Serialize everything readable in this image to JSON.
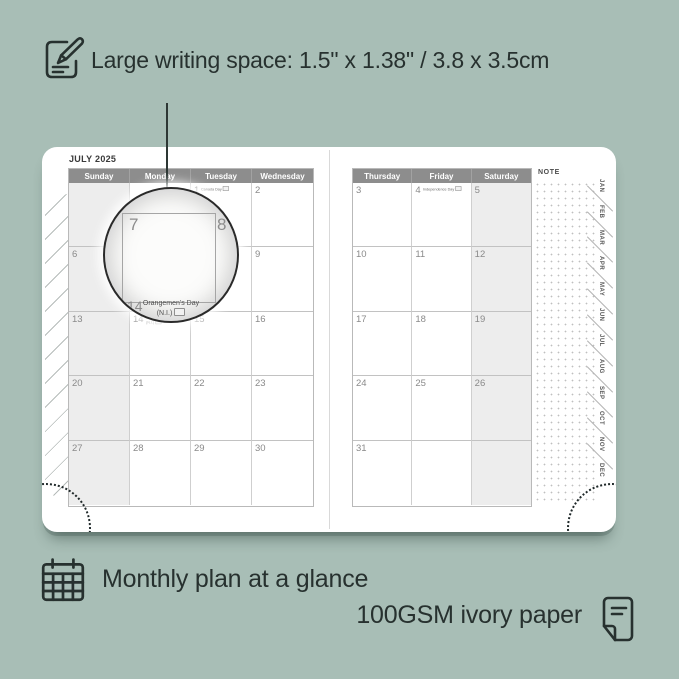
{
  "colors": {
    "background": "#a8beb6",
    "ink": "#27312f",
    "header_bar": "#8d8d8d",
    "shaded_column": "#ededed",
    "page": "#ffffff"
  },
  "callouts": {
    "writing_space": {
      "text": "Large writing space: 1.5\" x 1.38\" / 3.8 x 3.5cm",
      "icon": "pencil-note-icon"
    },
    "monthly_plan": {
      "text": "Monthly plan at a glance",
      "icon": "calendar-grid-icon"
    },
    "paper": {
      "text": "100GSM ivory paper",
      "icon": "paper-sheet-icon"
    }
  },
  "planner": {
    "month_title": "JULY 2025",
    "note_label": "NOTE",
    "left_page": {
      "headers": [
        "Sunday",
        "Monday",
        "Tuesday",
        "Wednesday"
      ],
      "rows": [
        [
          {
            "day": ""
          },
          {
            "day": ""
          },
          {
            "day": "1",
            "holiday": "Canada Day"
          },
          {
            "day": "2"
          }
        ],
        [
          {
            "day": "6"
          },
          {
            "day": "7"
          },
          {
            "day": "8"
          },
          {
            "day": "9"
          }
        ],
        [
          {
            "day": "13"
          },
          {
            "day": "14",
            "holiday": "Orangemen's Day",
            "holiday2": "(N.I.)"
          },
          {
            "day": "15"
          },
          {
            "day": "16"
          }
        ],
        [
          {
            "day": "20"
          },
          {
            "day": "21"
          },
          {
            "day": "22"
          },
          {
            "day": "23"
          }
        ],
        [
          {
            "day": "27"
          },
          {
            "day": "28"
          },
          {
            "day": "29"
          },
          {
            "day": "30"
          }
        ]
      ]
    },
    "right_page": {
      "headers": [
        "Thursday",
        "Friday",
        "Saturday"
      ],
      "rows": [
        [
          {
            "day": "3"
          },
          {
            "day": "4",
            "holiday": "Independence Day"
          },
          {
            "day": "5"
          }
        ],
        [
          {
            "day": "10"
          },
          {
            "day": "11"
          },
          {
            "day": "12"
          }
        ],
        [
          {
            "day": "17"
          },
          {
            "day": "18"
          },
          {
            "day": "19"
          }
        ],
        [
          {
            "day": "24"
          },
          {
            "day": "25"
          },
          {
            "day": "26"
          }
        ],
        [
          {
            "day": "31"
          },
          {
            "day": ""
          },
          {
            "day": ""
          }
        ]
      ]
    },
    "month_tabs": [
      "JAN",
      "FEB",
      "MAR",
      "APR",
      "MAY",
      "JUN",
      "JUL",
      "AUG",
      "SEP",
      "OCT",
      "NOV",
      "DEC"
    ],
    "magnifier": {
      "day": "7",
      "adjacent_day": "8",
      "below_day": "14",
      "holiday_line1": "Orangemen's Day",
      "holiday_line2": "(N.I.)"
    }
  }
}
